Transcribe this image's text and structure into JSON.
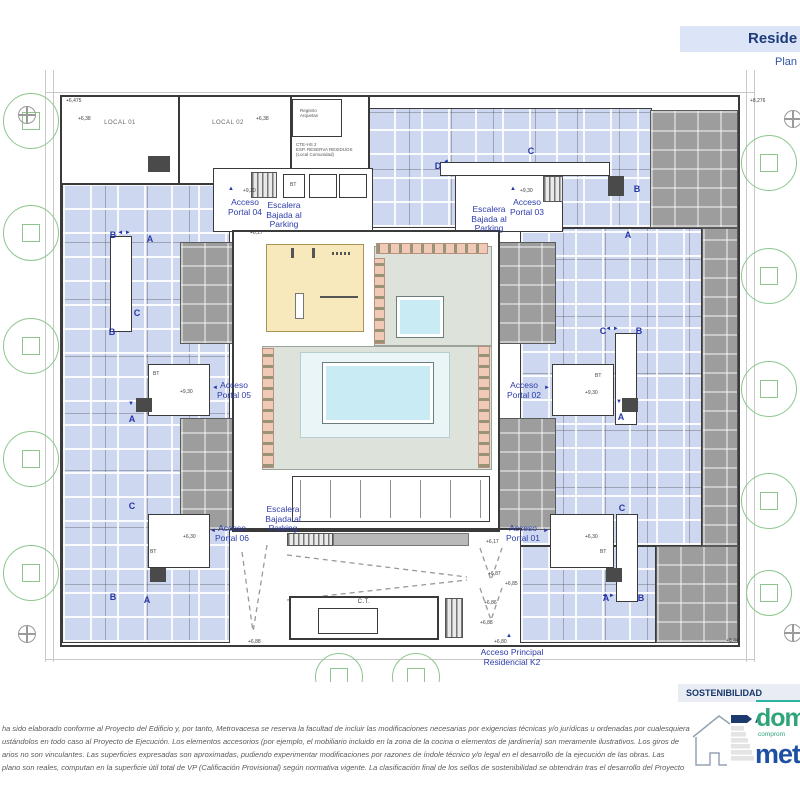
{
  "header": {
    "title": "Reside",
    "subtitle": "Plan"
  },
  "plan": {
    "local_01": "LOCAL 01",
    "local_02": "LOCAL 02",
    "registro": "Registro\nArquetas",
    "cte": "CTE-HS 2\nESP. RESERVA RESIDUOS\n(Local Comunidad)",
    "ct": "C.T.",
    "stair_label": "Escalera\nBajada al\nParking",
    "main_access": "Acceso Principal\nResidencial K2",
    "portals": [
      {
        "text": "Acceso\nPortal 04",
        "x": 245,
        "y": 198,
        "arrow": "▲",
        "ax": 231,
        "ay": 189
      },
      {
        "text": "Acceso\nPortal 03",
        "x": 527,
        "y": 198,
        "arrow": "▲",
        "ax": 513,
        "ay": 189
      },
      {
        "text": "Acceso\nPortal 05",
        "x": 234,
        "y": 381,
        "arrow": "◄",
        "ax": 215,
        "ay": 388
      },
      {
        "text": "Acceso\nPortal 02",
        "x": 524,
        "y": 381,
        "arrow": "►",
        "ax": 547,
        "ay": 388
      },
      {
        "text": "Acceso\nPortal 06",
        "x": 232,
        "y": 524,
        "arrow": "◄",
        "ax": 213,
        "ay": 531
      },
      {
        "text": "Acceso\nPortal 01",
        "x": 523,
        "y": 524,
        "arrow": "►",
        "ax": 546,
        "ay": 531
      }
    ],
    "stairs": [
      {
        "x": 284,
        "y": 201
      },
      {
        "x": 489,
        "y": 205
      },
      {
        "x": 283,
        "y": 505
      }
    ],
    "letters": [
      {
        "t": "B",
        "x": 113,
        "y": 235
      },
      {
        "t": "A",
        "x": 150,
        "y": 239
      },
      {
        "t": "C",
        "x": 137,
        "y": 313
      },
      {
        "t": "B",
        "x": 112,
        "y": 332
      },
      {
        "t": "A",
        "x": 132,
        "y": 419
      },
      {
        "t": "C",
        "x": 132,
        "y": 506
      },
      {
        "t": "B",
        "x": 113,
        "y": 597
      },
      {
        "t": "A",
        "x": 147,
        "y": 600
      },
      {
        "t": "D",
        "x": 438,
        "y": 166
      },
      {
        "t": "C",
        "x": 531,
        "y": 151
      },
      {
        "t": "B",
        "x": 637,
        "y": 189
      },
      {
        "t": "A",
        "x": 628,
        "y": 235
      },
      {
        "t": "C",
        "x": 603,
        "y": 331
      },
      {
        "t": "B",
        "x": 639,
        "y": 331
      },
      {
        "t": "A",
        "x": 621,
        "y": 417
      },
      {
        "t": "C",
        "x": 622,
        "y": 508
      },
      {
        "t": "A",
        "x": 606,
        "y": 598
      },
      {
        "t": "B",
        "x": 641,
        "y": 598
      }
    ],
    "arrow_marks": [
      {
        "t": "◄ ►",
        "x": 124,
        "y": 233
      },
      {
        "t": "◄ ►",
        "x": 612,
        "y": 329
      },
      {
        "t": "◄ ►",
        "x": 608,
        "y": 596
      },
      {
        "t": "◄",
        "x": 446,
        "y": 162
      },
      {
        "t": "▼",
        "x": 131,
        "y": 404
      },
      {
        "t": "▼",
        "x": 619,
        "y": 402
      },
      {
        "t": "▲",
        "x": 509,
        "y": 636
      }
    ],
    "bt_labels": [
      {
        "x": 290,
        "y": 182
      },
      {
        "x": 153,
        "y": 371
      },
      {
        "x": 595,
        "y": 373
      },
      {
        "x": 150,
        "y": 549
      },
      {
        "x": 600,
        "y": 549
      }
    ],
    "bt_text": "BT",
    "levels": [
      {
        "t": "+6,475",
        "x": 66,
        "y": 98
      },
      {
        "t": "+8,276",
        "x": 750,
        "y": 98
      },
      {
        "t": "+6,38",
        "x": 78,
        "y": 116
      },
      {
        "t": "+6,38",
        "x": 256,
        "y": 116
      },
      {
        "t": "+9,30",
        "x": 243,
        "y": 188
      },
      {
        "t": "+9,30",
        "x": 520,
        "y": 188
      },
      {
        "t": "+6,17",
        "x": 250,
        "y": 230
      },
      {
        "t": "+9,30",
        "x": 180,
        "y": 389
      },
      {
        "t": "+9,30",
        "x": 585,
        "y": 390
      },
      {
        "t": "+6,30",
        "x": 183,
        "y": 534
      },
      {
        "t": "+6,30",
        "x": 585,
        "y": 534
      },
      {
        "t": "+6,17",
        "x": 486,
        "y": 539
      },
      {
        "t": "+6,87",
        "x": 488,
        "y": 571
      },
      {
        "t": "+6,85",
        "x": 505,
        "y": 581
      },
      {
        "t": "+6,86",
        "x": 484,
        "y": 600
      },
      {
        "t": "+6,88",
        "x": 480,
        "y": 620
      },
      {
        "t": "+6,88",
        "x": 248,
        "y": 639
      },
      {
        "t": "+6,80",
        "x": 494,
        "y": 639
      },
      {
        "t": "+8,44",
        "x": 726,
        "y": 638
      }
    ],
    "trees": [
      {
        "x": 30,
        "y": 120,
        "r": 27
      },
      {
        "x": 30,
        "y": 232,
        "r": 27
      },
      {
        "x": 30,
        "y": 345,
        "r": 27
      },
      {
        "x": 30,
        "y": 458,
        "r": 27
      },
      {
        "x": 30,
        "y": 572,
        "r": 27
      },
      {
        "x": 768,
        "y": 162,
        "r": 27
      },
      {
        "x": 768,
        "y": 275,
        "r": 27
      },
      {
        "x": 768,
        "y": 388,
        "r": 27
      },
      {
        "x": 768,
        "y": 500,
        "r": 27
      },
      {
        "x": 768,
        "y": 592,
        "r": 22
      },
      {
        "x": 338,
        "y": 676,
        "r": 23
      },
      {
        "x": 415,
        "y": 676,
        "r": 23
      }
    ],
    "manholes": [
      {
        "x": 26,
        "y": 114
      },
      {
        "x": 792,
        "y": 118
      },
      {
        "x": 26,
        "y": 633
      },
      {
        "x": 792,
        "y": 632
      }
    ]
  },
  "footer": {
    "disclaimer_lines": [
      "ha sido elaborado conforme al Proyecto del Edificio y, por tanto, Metrovacesa se reserva la facultad de incluir las modificaciones necesarias por exigencias técnicas y/o jurídicas u ordenadas por cualesquiera",
      "ustándolos en todo caso al Proyecto de Ejecución. Los elementos accesorios (por ejemplo, el mobiliario incluido en la zona de la cocina o elementos de jardinería) son meramente ilustrativos. Los giros de",
      "arios no son vinculantes. Las superficies expresadas son aproximadas, pudiendo experimentar modificaciones por razones de índole técnico y/o legal en el desarrollo de la ejecución de las obras. Las",
      "plano son reales, computan en la superficie útil total de VP (Calificación Provisional) según normativa vigente. La clasificación final de los sellos de sostenibilidad se obtendrán tras el desarrollo del Proyecto"
    ]
  },
  "sustainability": {
    "title": "SOSTENIBILIDAD",
    "rating": "A",
    "logo_green": "dom",
    "logo_green_sub": "comprom",
    "logo_blue": "met",
    "colors": {
      "accent_teal": "#2ab5a5",
      "logo_green": "#2fa579",
      "logo_blue": "#1d4fa2",
      "rating_navy": "#1d3a6e"
    }
  }
}
